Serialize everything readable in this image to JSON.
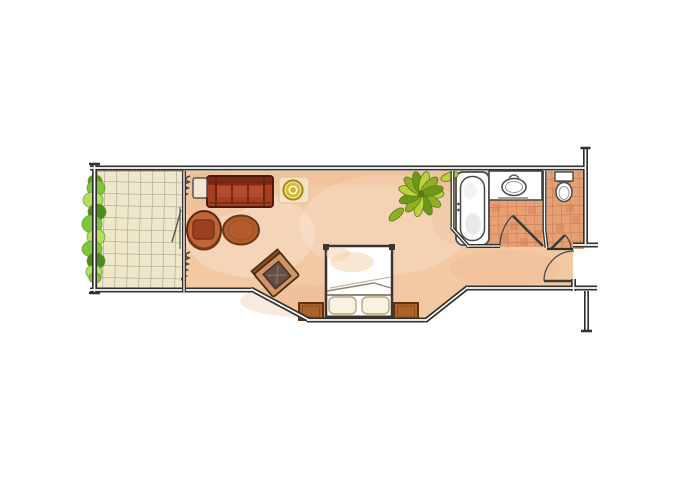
{
  "scene": {
    "description": "Hand-drawn watercolor floor plan of a hotel room: balcony with hedge, combined living and sleeping room, bathroom with tub, washbasin and WC, entrance hall",
    "rooms": [
      "balcony",
      "living-sleeping-room",
      "bathroom",
      "wc",
      "entrance-hall"
    ],
    "furniture": [
      "sofa",
      "side-table",
      "floor-lamp",
      "tub-armchair",
      "oval-coffee-table",
      "desk-chair",
      "double-bed",
      "nightstand-left",
      "nightstand-right",
      "potted-plant",
      "bathtub",
      "washbasin",
      "toilet"
    ],
    "door_count": 3,
    "sofa_cushions": 3,
    "bed_pillows": 2
  },
  "palette": {
    "paper": "#ffffff",
    "wall_line": "#33302b",
    "floor_base": "#f3c9a4",
    "floor_deep": "#e9ad80",
    "balcony_tile_base": "#efe7c9",
    "balcony_tile_line": "#98968a",
    "bath_tile_base": "#e7a074",
    "bath_tile_line": "#c26f49",
    "bath_tile_dark": "#d4815a",
    "fixture_white": "#ffffff",
    "sofa_base": "#a63d1f",
    "sofa_dark": "#7e2a12",
    "sofa_light": "#c4603b",
    "armchair": "#c06535",
    "armchair_seat": "#9c4020",
    "table_oval": "#b25c2e",
    "chair_frame": "#cf9368",
    "chair_back": "#8a4a22",
    "chair_cushion": "#665043",
    "nightstand": "#ac6229",
    "pillow": "#f9f1e2",
    "side_table": "#f2e4cf",
    "lamp_yellow": "#e0bd25",
    "lamp_ring": "#a8891c",
    "plant_light": "#bdd13f",
    "plant_mid": "#8fb024",
    "plant_dark": "#6f961c",
    "hedge_light": "#b5dd5f",
    "hedge_mid": "#7fc63c",
    "hedge_dark": "#4d8c1c"
  }
}
